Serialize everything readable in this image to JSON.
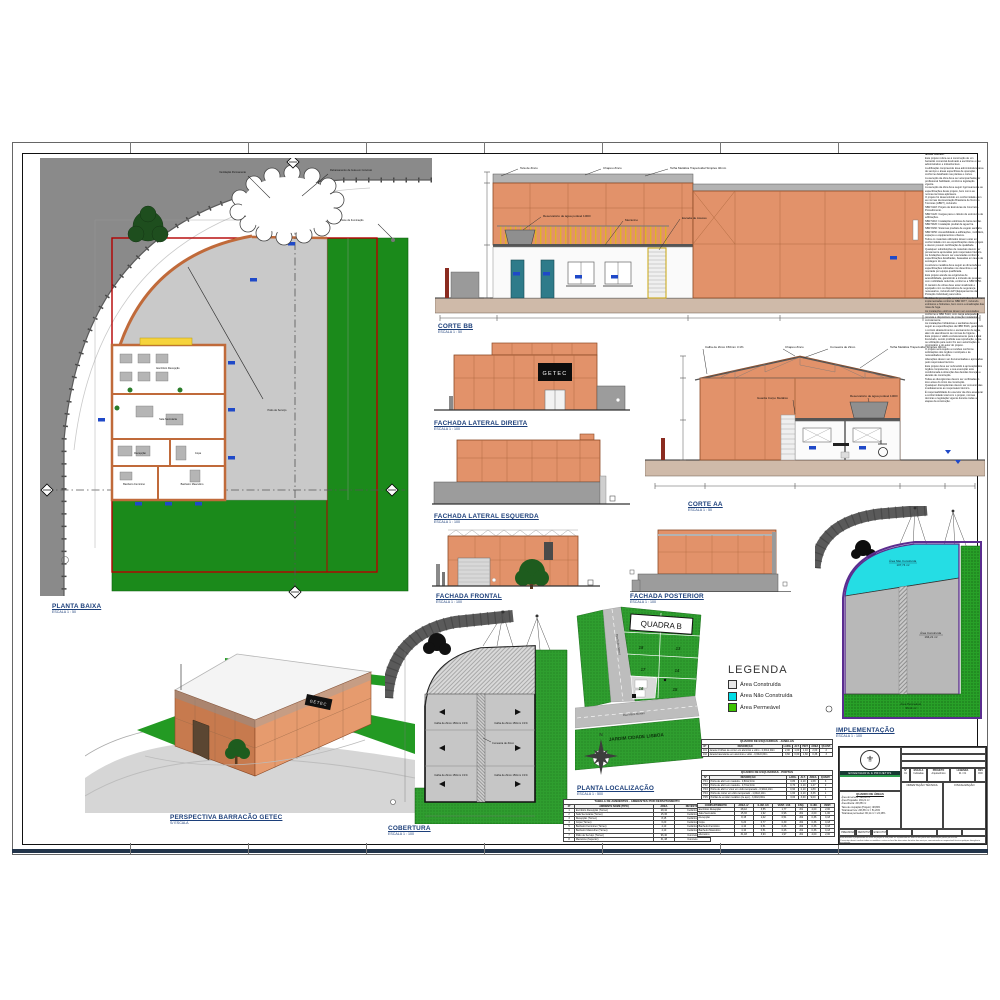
{
  "views": {
    "planta_baixa": {
      "title": "PLANTA BAIXA",
      "scale": "ESCALA 1 : 50",
      "rooms": {
        "office": "Escritório Recepção",
        "secretaria": "Sala Secretaria",
        "recepcao": "Recepção",
        "copa": "Copa",
        "wc_fem": "Banheiro Feminino",
        "wc_masc": "Banheiro Masculino",
        "patio": "Pátio de Serviço"
      },
      "ann": {
        "a1": "Ventilação Permanente",
        "a2": "Rebaixamento de Guia em Concreto",
        "a3": "Poste de Iluminação"
      }
    },
    "corte_bb": {
      "title": "CORTE BB",
      "scale": "ESCALA 1 : 50",
      "ann": {
        "a1": "Tela de Zinco",
        "a2": "Chapéu Zinco",
        "a3": "Telha Metálica Trapezoidal Simples 40mm",
        "a4": "Reservatório de água potável 1000l",
        "a5": "Mezanino",
        "a6": "Escada de Acesso"
      }
    },
    "fachada_lateral_direita": {
      "title": "FACHADA LATERAL DIREITA",
      "scale": "ESCALA 1 : 100",
      "sign": "GETEC"
    },
    "fachada_lateral_esquerda": {
      "title": "FACHADA LATERAL ESQUERDA",
      "scale": "ESCALA 1 : 100"
    },
    "corte_aa": {
      "title": "CORTE AA",
      "scale": "ESCALA 1 : 50",
      "ann": {
        "a1": "Calha de Zinco 150mm i=1%",
        "a2": "Chapéu Zinco",
        "a3": "Cumeeira de Zinco",
        "a4": "Telha Metálica Trapezoidal Simples 40mm",
        "a5": "Guarda Corpo Metálico",
        "a6": "Reservatório de água potável 1000l"
      }
    },
    "fachada_frontal": {
      "title": "FACHADA FRONTAL",
      "scale": "ESCALA 1 : 100"
    },
    "fachada_posterior": {
      "title": "FACHADA POSTERIOR",
      "scale": "ESCALA 1 : 100"
    },
    "perspectiva": {
      "title": "PERSPECTIVA BARRACÃO GETEC",
      "scale": "S/ ESCALA",
      "sign": "GETEC"
    },
    "cobertura": {
      "title": "COBERTURA",
      "scale": "ESCALA 1 : 100",
      "ann": {
        "calha": "Calha de Zinco 150mm i=1%",
        "cumeeira": "Cumeeira de Zinco"
      }
    },
    "planta_localizacao": {
      "title": "PLANTA LOCALIZAÇÃO",
      "scale": "ESCALA 1 : 500",
      "quadra": "QUADRA B",
      "lots": [
        "19",
        "12",
        "18",
        "13",
        "17",
        "14",
        "16",
        "15"
      ],
      "street_left": "Rua Pedro Maset",
      "street_bottom": "Rua Mário Montini",
      "district": "JARDIM CIDADE LISBOA",
      "north": "N"
    },
    "implementacao": {
      "title": "IMPLEMENTAÇÃO",
      "scale": "ESCALA 1 : 100",
      "areas": {
        "nao_construida": {
          "label": "Área Não Construída",
          "value": "107,74 m²"
        },
        "construida": {
          "label": "Área Construída",
          "value": "194,21 m²"
        },
        "permeavel": {
          "label": "Área Permeável",
          "value": "96,11 m²"
        }
      }
    }
  },
  "legend": {
    "title": "LEGENDA",
    "items": [
      {
        "label": "Área Construída",
        "color": "#e8e8e8"
      },
      {
        "label": "Área Não Construída",
        "color": "#00dde6"
      },
      {
        "label": "Área Permeável",
        "color": "#3ec400"
      }
    ]
  },
  "notes": {
    "title": "Notas Gerais:",
    "lines": [
      "Este projeto refere-se à construção de um barracão comercial destinado a escritórios e uso administrativo e industrial leve.",
      "A edificação compreende área administrativa, área de serviço e áreas específicas de operação, conforme detalhado nas plantas e cortes.",
      "A execução da obra deve ser acompanhada por profissional habilitado, conforme legislação vigente.",
      "A execução da obra deve seguir rigorosamente as especificações deste projeto, bem como as normas técnicas aplicáveis.",
      "O projeto foi desenvolvido em conformidade com as normas da Associação Brasileira de Normas Técnicas (ABNT), incluindo:",
      "NBR 6118: Projeto de Estruturas de Concreto - Procedimento.",
      "NBR 6120: Cargas para o cálculo de estruturas de edificações.",
      "NBR 5410: Instalações elétricas de baixa tensão.",
      "NBR 5626: Instalação predial de água fria.",
      "NBR 8160: Sistemas prediais de esgoto sanitário.",
      "NBR 9050: Acessibilidade a edificações, mobiliário, espaços e equipamentos urbanos.",
      "Todos os materiais utilizados devem estar em conformidade com as especificações deste projeto e devem possuir certificação de qualidade.",
      "Quaisquer substituições de materiais devem ser previamente aprovadas pelo responsável técnico.",
      "As fundações devem ser executadas conforme especificações detalhadas, baseadas em laudo de sondagem do solo.",
      "A estrutura metálica deve seguir as dimensões e especificações indicadas nos desenhos e ser montada por equipe qualificada.",
      "Este projeto atende às exigências de acessibilidade, garantindo a inclusão de pessoas com mobilidade reduzida, conforme a NBR 9050.",
      "O canteiro de obras deve estar sinalizado e equipado com os dispositivos de segurança necessários, incluindo EPI (Equipamentos de Proteção Individual) para todos.",
      "Medidas de prevenção contra incêndios devem ser implementadas conforme NBR 9077, incluindo extintores e hidrantes, bem como a sinalização das rotas de fuga.",
      "As instalações elétricas devem ser executadas conforme a NBR 5410, com carga adequada à prevista e dispositivos de proteção instalados corretamente.",
      "As instalações hidráulicas e sanitárias devem seguir as especificações da NBR 5626, garantindo o correto abastecimento e escoamento de água, além do atendimento às normas de higiene.",
      "Este projeto é válido exclusivamente para o local licenciado, sendo proibida sua reprodução, cópia ou utilização para outro fim sem autorização do proprietário e do autor do projeto.",
      "O projeto será sujeito a revisões conforme solicitações dos órgãos municipais e às necessidades da obra.",
      "Alterações devem ser documentadas e aprovadas pelo responsável técnico.",
      "Este projeto deve ser submetido à aprovação dos órgãos competentes, e sua execução está condicionada à obtenção das devidas licenças e alvarás de construção.",
      "Todas as divergências devem ser verificadas in loco antes do início da construção.",
      "Quaisquer discrepâncias devem ser comunicadas imediatamente ao responsável técnico.",
      "É responsabilidade do executor da obra assegurar a conformidade total com o projeto, normas técnicas e legislação vigente durante todas as etapas da construção."
    ]
  },
  "tables": {
    "janelas": {
      "title": "QUADRO DE ESQUADRIAS - JANELAS",
      "headers": [
        "Nº",
        "DESCRIÇÃO",
        "LARG.",
        "ALT.",
        "PEIT.",
        "ÁREA",
        "QUANT."
      ],
      "rows": [
        {
          "n": "J01",
          "d": "Janela 4 folhas de correr em alumínio e vidro - 2,00x1,00m",
          "l": "2,00",
          "a": "1,00",
          "p": "1,10",
          "ar": "2,00",
          "q": "2"
        },
        {
          "n": "J02",
          "d": "Janela basculante em alumínio e vidro - 0,60x0,60m",
          "l": "0,60",
          "a": "0,60",
          "p": "1,60",
          "ar": "0,36",
          "q": "3"
        }
      ]
    },
    "portas": {
      "title": "QUADRO DE ESQUADRIAS - PORTAS",
      "headers": [
        "Nº",
        "DESCRIÇÃO",
        "LARG.",
        "ALT.",
        "ÁREA",
        "QUANT."
      ],
      "rows": [
        {
          "n": "P01",
          "d": "Porta de abrir em madeira - 0,80x2,10m",
          "l": "0,80",
          "a": "2,10",
          "ar": "1,68",
          "q": "3"
        },
        {
          "n": "P02",
          "d": "Porta de abrir em madeira - 0,70x2,10m",
          "l": "0,70",
          "a": "2,10",
          "ar": "1,47",
          "q": "2"
        },
        {
          "n": "P03",
          "d": "Porta de abrir c/ visor em vidro temperado - 0,90x2,10m",
          "l": "0,90",
          "a": "2,10",
          "ar": "1,89",
          "q": "1"
        },
        {
          "n": "P04",
          "d": "Porta de correr em vidro temperado - 1,60x2,10m",
          "l": "1,60",
          "a": "2,10",
          "ar": "3,36",
          "q": "1"
        },
        {
          "n": "P05",
          "d": "Portão de enrolar metálico (de aço) - 3,00x3,00m",
          "l": "3,00",
          "a": "3,00",
          "ar": "9,00",
          "q": "1"
        }
      ]
    },
    "ambientes": {
      "title": "TABELA DE AMBIENTES - AMBIENTES POR DEPARTAMENTO",
      "headers": [
        "Nº",
        "AMBIENTE NOME (TIPO)",
        "ÁREA",
        "REVESTIM."
      ],
      "rows": [
        {
          "n": "1",
          "d": "Escritório Recepção (Térreo)",
          "a": "28,42",
          "r": "Cerâmico"
        },
        {
          "n": "2",
          "d": "Sala Secretaria (Térreo)",
          "a": "15,36",
          "r": "Cerâmico"
        },
        {
          "n": "3",
          "d": "Recepção (Térreo)",
          "a": "8,15",
          "r": "Cerâmico"
        },
        {
          "n": "4",
          "d": "Copa (Térreo)",
          "a": "6,20",
          "r": "Cerâmico"
        },
        {
          "n": "5",
          "d": "Banheiro Feminino (Térreo)",
          "a": "4,10",
          "r": "Cerâmico"
        },
        {
          "n": "6",
          "d": "Banheiro Masculino (Térreo)",
          "a": "4,10",
          "r": "Cerâmico"
        },
        {
          "n": "7",
          "d": "Pátio de Serviço (Térreo)",
          "a": "96,40",
          "r": "Concreto"
        },
        {
          "n": "8",
          "d": "Mezanino (Superior)",
          "a": "31,48",
          "r": "Concreto"
        }
      ]
    },
    "compartimentos": {
      "title": "QUADRO DE ILUMINAÇÃO E VENTILAÇÃO",
      "headers": [
        "COMPARTIMENTO",
        "ÁREA m²",
        "ILUM. 1/8",
        "VENT. 1/16",
        "ESQ.",
        "ILUM.",
        "VENT."
      ],
      "rows": [
        {
          "c": "Escritório Recepção",
          "a": "28,42",
          "i": "3,55",
          "v": "1,77",
          "e": "J01",
          "il": "4,00",
          "vt": "2,00"
        },
        {
          "c": "Sala Secretaria",
          "a": "15,36",
          "i": "1,92",
          "v": "0,96",
          "e": "J01",
          "il": "2,00",
          "vt": "1,00"
        },
        {
          "c": "Recepção",
          "a": "8,15",
          "i": "1,02",
          "v": "0,51",
          "e": "J02",
          "il": "0,36",
          "vt": "0,18"
        },
        {
          "c": "Copa",
          "a": "6,20",
          "i": "0,77",
          "v": "0,39",
          "e": "J02",
          "il": "0,36",
          "vt": "0,18"
        },
        {
          "c": "Banheiro Feminino",
          "a": "4,10",
          "i": "0,51",
          "v": "0,26",
          "e": "J02",
          "il": "0,36",
          "vt": "0,18"
        },
        {
          "c": "Banheiro Masculino",
          "a": "4,10",
          "i": "0,51",
          "v": "0,26",
          "e": "J02",
          "il": "0,36",
          "vt": "0,18"
        },
        {
          "c": "Mezanino",
          "a": "31,48",
          "i": "3,93",
          "v": "1,97",
          "e": "J01",
          "il": "4,00",
          "vt": "2,00"
        }
      ]
    }
  },
  "titleblock": {
    "company": "ENGENHARIA & PROJETOS",
    "emblem": "⚜",
    "fields": [
      {
        "label": "PROPRIETÁRIO:",
        "value": "GETEC"
      },
      {
        "label": "ENDEREÇO:",
        "value": "Rua Mário Montini, Quadra B - Lotes 15/16 - Jardim Cidade Lisboa"
      },
      {
        "label": "DESCRIÇÃO:",
        "value": "Barracão Comercial GETEC"
      }
    ],
    "cols": [
      {
        "label": "Nº",
        "value": "01"
      },
      {
        "label": "ESCALA",
        "value": "Indicadas"
      },
      {
        "label": "PROJETO",
        "value": "Arquitetônico"
      },
      {
        "label": "LEGENDA",
        "value": "01 / 01"
      },
      {
        "label": "REV",
        "value": "R00"
      }
    ],
    "quadro_areas": {
      "title": "QUADRO DE ÁREAS",
      "lines": [
        "Área do terreno: 398,06 m²",
        "Área Projetada: 194,21 m²",
        "Área Aberta: 203,85 m²",
        "Taxa de ocupação (Projeto): 48,80%",
        "Total área livre: 203,85 m² = 51,20%",
        "Total área permeável: 96,11 m² = 24,15%"
      ]
    },
    "orientacao": "ORIENTAÇÃO TÉCNICA",
    "fiscalizacao": "FISCALIZAÇÃO",
    "status": [
      "PRELIMINAR",
      "DEFINITIVO",
      "EXECUTIVO"
    ],
    "approvals": [
      "PROJETISTA",
      "DESENHISTA",
      "VERIFICADO",
      "APROVADO"
    ],
    "disclaimer": [
      "Este desenho é propriedade do autor do projeto e não pode ser reproduzido no todo ou em parte sem autorização prévia por escrito.",
      "O executor deverá conferir todas as medidas e cotas no local da obra antes do início dos serviços, comunicando ao responsável técnico qualquer divergência encontrada.",
      "Prevalecem as cotas indicadas sobre as medidas tomadas em escala no desenho."
    ]
  }
}
